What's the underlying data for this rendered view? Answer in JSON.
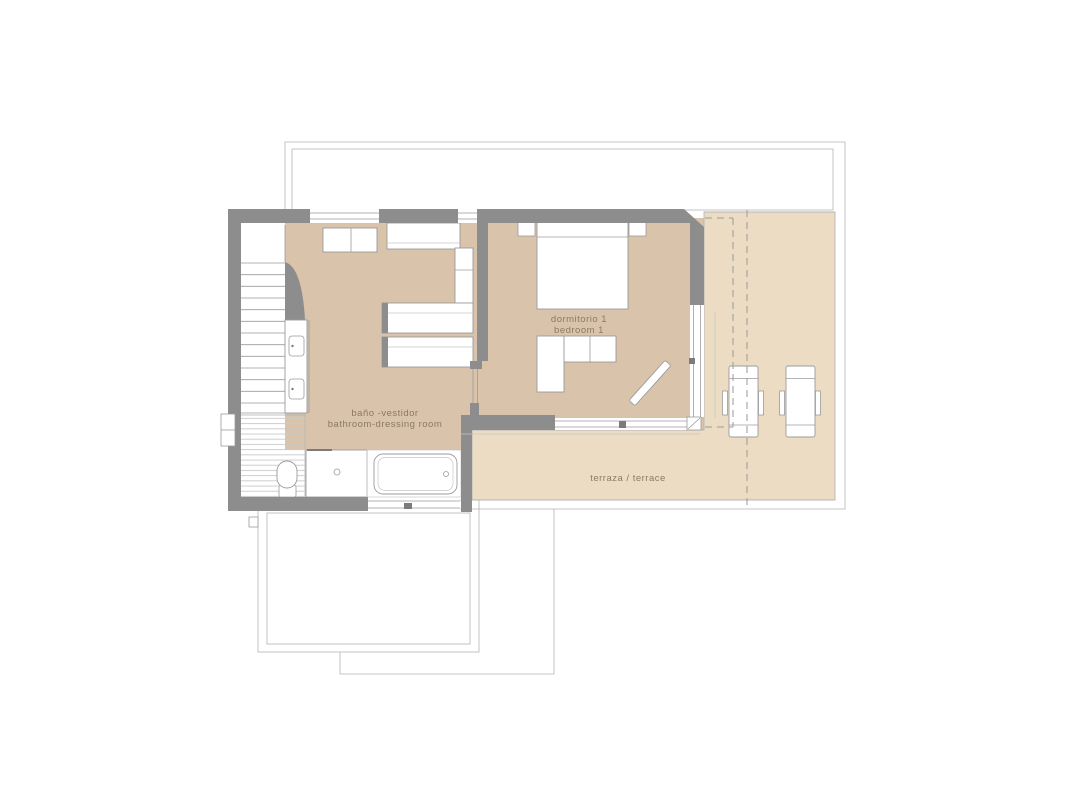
{
  "plan": {
    "labels": {
      "bathroom_line1": "baño -vestidor",
      "bathroom_line2": "bathroom-dressing room",
      "bedroom_line1": "dormitorio 1",
      "bedroom_line2": "bedroom 1",
      "terrace": "terraza / terrace"
    },
    "colors": {
      "background": "#ffffff",
      "room_fill": "#d9c3aa",
      "terrace_fill": "#ecdcc3",
      "wall": "#8d8d8d",
      "outline": "#9b9b9b",
      "thin_line": "#b5b5b5",
      "stripe": "#c9c9c9",
      "dot": "#6f6f6f",
      "text": "#8c7a66"
    }
  }
}
